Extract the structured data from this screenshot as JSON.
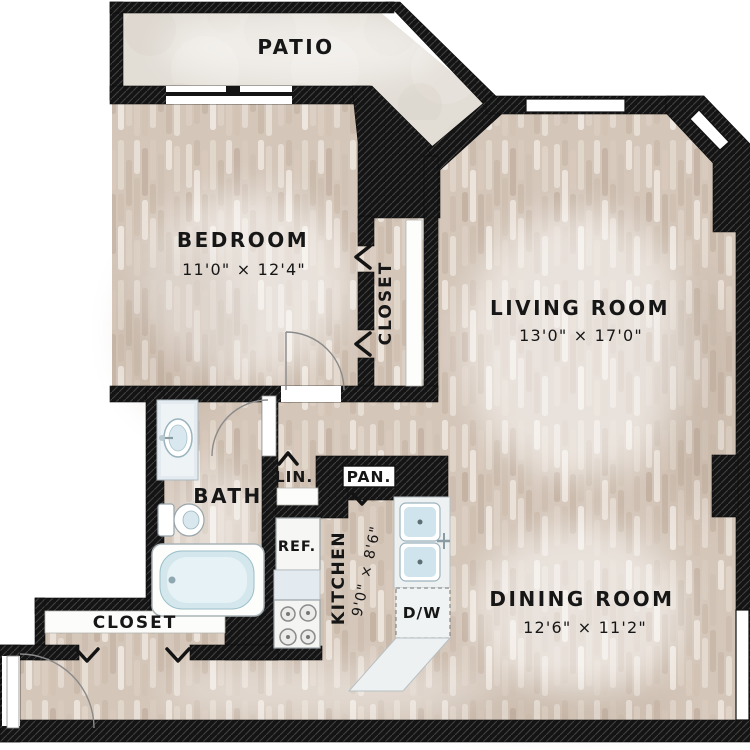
{
  "floor_plan": {
    "rooms": {
      "patio": {
        "label": "PATIO"
      },
      "bedroom": {
        "label": "BEDROOM",
        "dims": "11'0\" × 12'4\""
      },
      "bedroom_closet": {
        "label": "CLOSET"
      },
      "living_room": {
        "label": "LIVING ROOM",
        "dims": "13'0\" × 17'0\""
      },
      "bath": {
        "label": "BATH"
      },
      "linen_closet": {
        "label": "LIN."
      },
      "pantry": {
        "label": "PAN."
      },
      "kitchen": {
        "label": "KITCHEN",
        "dims": "9'0\" × 8'6\""
      },
      "dining_room": {
        "label": "DINING ROOM",
        "dims": "12'6\" × 11'2\""
      },
      "entry_closet": {
        "label": "CLOSET"
      }
    },
    "fixtures": {
      "refrigerator": {
        "label": "REF."
      },
      "dishwasher": {
        "label": "D/W"
      }
    },
    "colors": {
      "wall": "#141414",
      "wood_floor": "#d4c6b9",
      "patio_floor": "#e2ddd5",
      "fixture_white": "#f4f5f3",
      "fixture_blue": "#cfe3ea"
    }
  }
}
